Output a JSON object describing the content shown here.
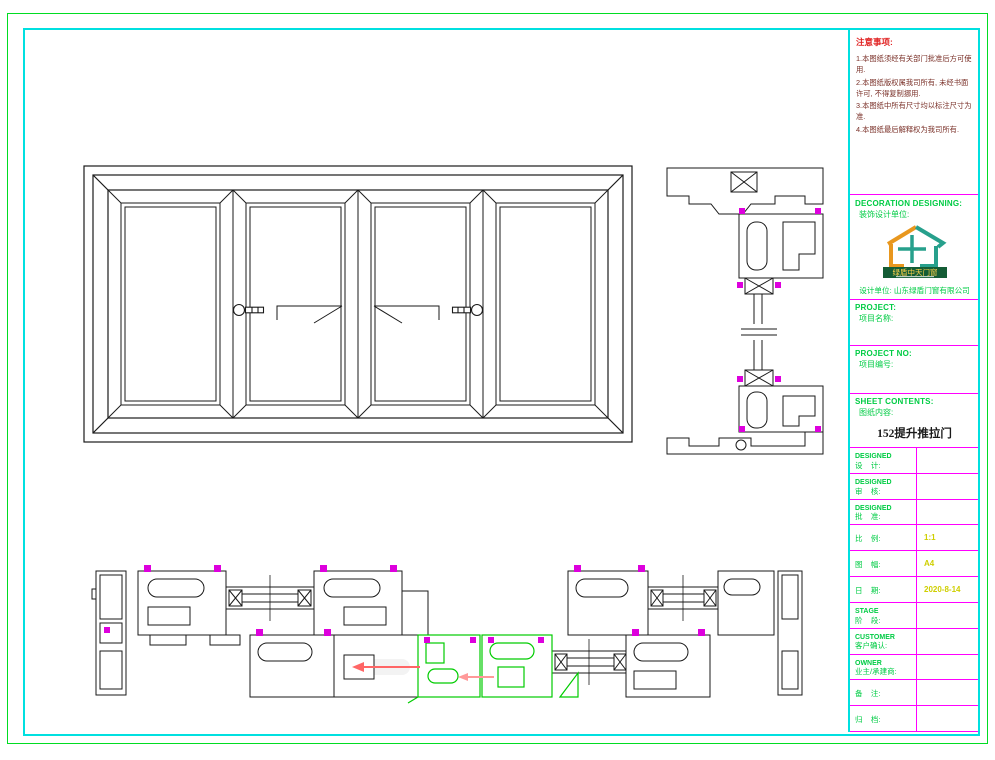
{
  "title_block": {
    "notes": {
      "title": "注意事项:",
      "items": [
        "1.本图纸须经有关部门批准后方可使用.",
        "2.本图纸版权属我司所有, 未经书面许可, 不得复制挪用.",
        "3.本图纸中所有尺寸均以标注尺寸为准.",
        "4.本图纸最后解释权为我司所有."
      ]
    },
    "decoration": {
      "en": "DECORATION DESIGNING:",
      "zh": "装饰设计单位:",
      "logo_name": "绿盾中天门窗",
      "company": "设计单位: 山东绿盾门窗有限公司"
    },
    "project": {
      "en": "PROJECT:",
      "zh": "项目名称:"
    },
    "project_no": {
      "en": "PROJECT NO:",
      "zh": "项目编号:"
    },
    "sheet": {
      "en": "SHEET CONTENTS:",
      "zh": "图纸内容:",
      "value": "152提升推拉门"
    },
    "rows": [
      {
        "en": "DESIGNED",
        "zh": "设    计:",
        "value": ""
      },
      {
        "en": "DESIGNED",
        "zh": "审    核:",
        "value": ""
      },
      {
        "en": "DESIGNED",
        "zh": "批    准:",
        "value": ""
      },
      {
        "en": "",
        "zh": "比    例:",
        "value": "1:1"
      },
      {
        "en": "",
        "zh": "图    幅:",
        "value": "A4"
      },
      {
        "en": "",
        "zh": "日    期:",
        "value": "2020-8-14"
      },
      {
        "en": "STAGE",
        "zh": "阶    段:",
        "value": ""
      },
      {
        "en": "CUSTOMER",
        "zh": "客户确认:",
        "value": ""
      },
      {
        "en": "OWNER",
        "zh": "业主/承建商:",
        "value": ""
      },
      {
        "en": "",
        "zh": "备    注:",
        "value": ""
      },
      {
        "en": "",
        "zh": "归    档:",
        "value": ""
      }
    ]
  },
  "colors": {
    "border_green": "#00dd22",
    "border_cyan": "#00e0e0",
    "divider_magenta": "#ff00ff",
    "label_green": "#00cc44",
    "value_yellow": "#cfcf00",
    "notes_title_red": "#e02020",
    "notes_body": "#7a3028",
    "linework_black": "#1a1a1a",
    "highlight_green": "#00cc00",
    "gasket_magenta": "#dd00dd",
    "arrow_red": "#ff6666",
    "logo_orange": "#e8971e",
    "logo_teal": "#27a08c",
    "logo_banner_green": "#145c35",
    "logo_text_yellow": "#ffd24a"
  }
}
